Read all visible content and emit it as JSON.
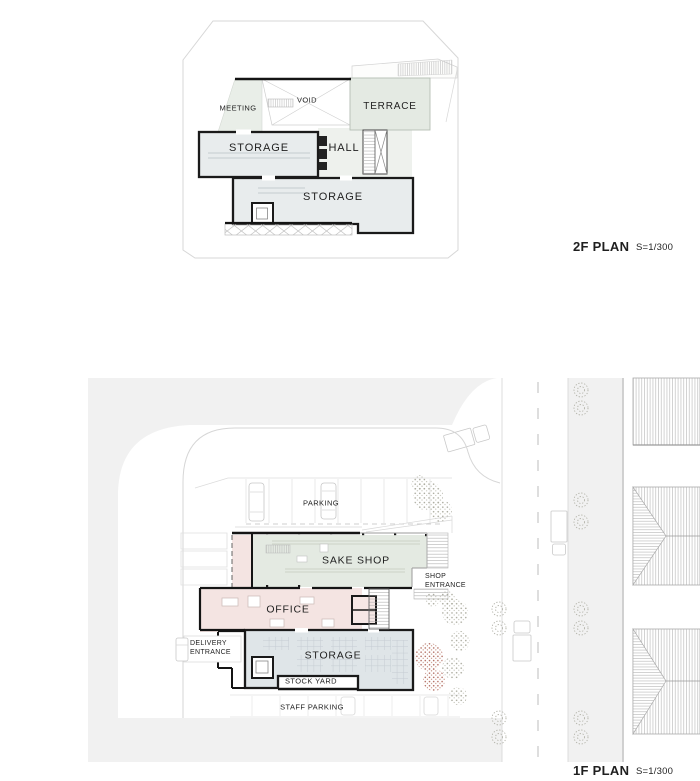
{
  "plan_2f": {
    "title": "2F PLAN",
    "scale": "S=1/300",
    "rooms": {
      "meeting": "MEETING",
      "void": "VOID",
      "terrace": "TERRACE",
      "storage_upper": "STORAGE",
      "hall": "HALL",
      "storage_lower": "STORAGE"
    }
  },
  "plan_1f": {
    "title": "1F PLAN",
    "scale": "S=1/300",
    "areas": {
      "parking": "PARKING",
      "sake_shop": "SAKE SHOP",
      "shop_entrance": "SHOP\nENTRANCE",
      "office": "OFFICE",
      "delivery_entrance": "DELIVERY\nENTRANCE",
      "storage": "STORAGE",
      "stock_yard": "STOCK YARD",
      "staff_parking": "STAFF PARKING"
    }
  },
  "colors": {
    "room_green": "#e4eae2",
    "room_pink": "#f4e4e2",
    "room_bluegray": "#e8eced",
    "storage_bluegray_1f": "#dfe5e8",
    "road_gray": "#f1f1f1",
    "wall_black": "#141414",
    "line_gray": "#d6d6d6",
    "tree_red": "#b06a5e",
    "tree_gray": "#a9a99c"
  }
}
